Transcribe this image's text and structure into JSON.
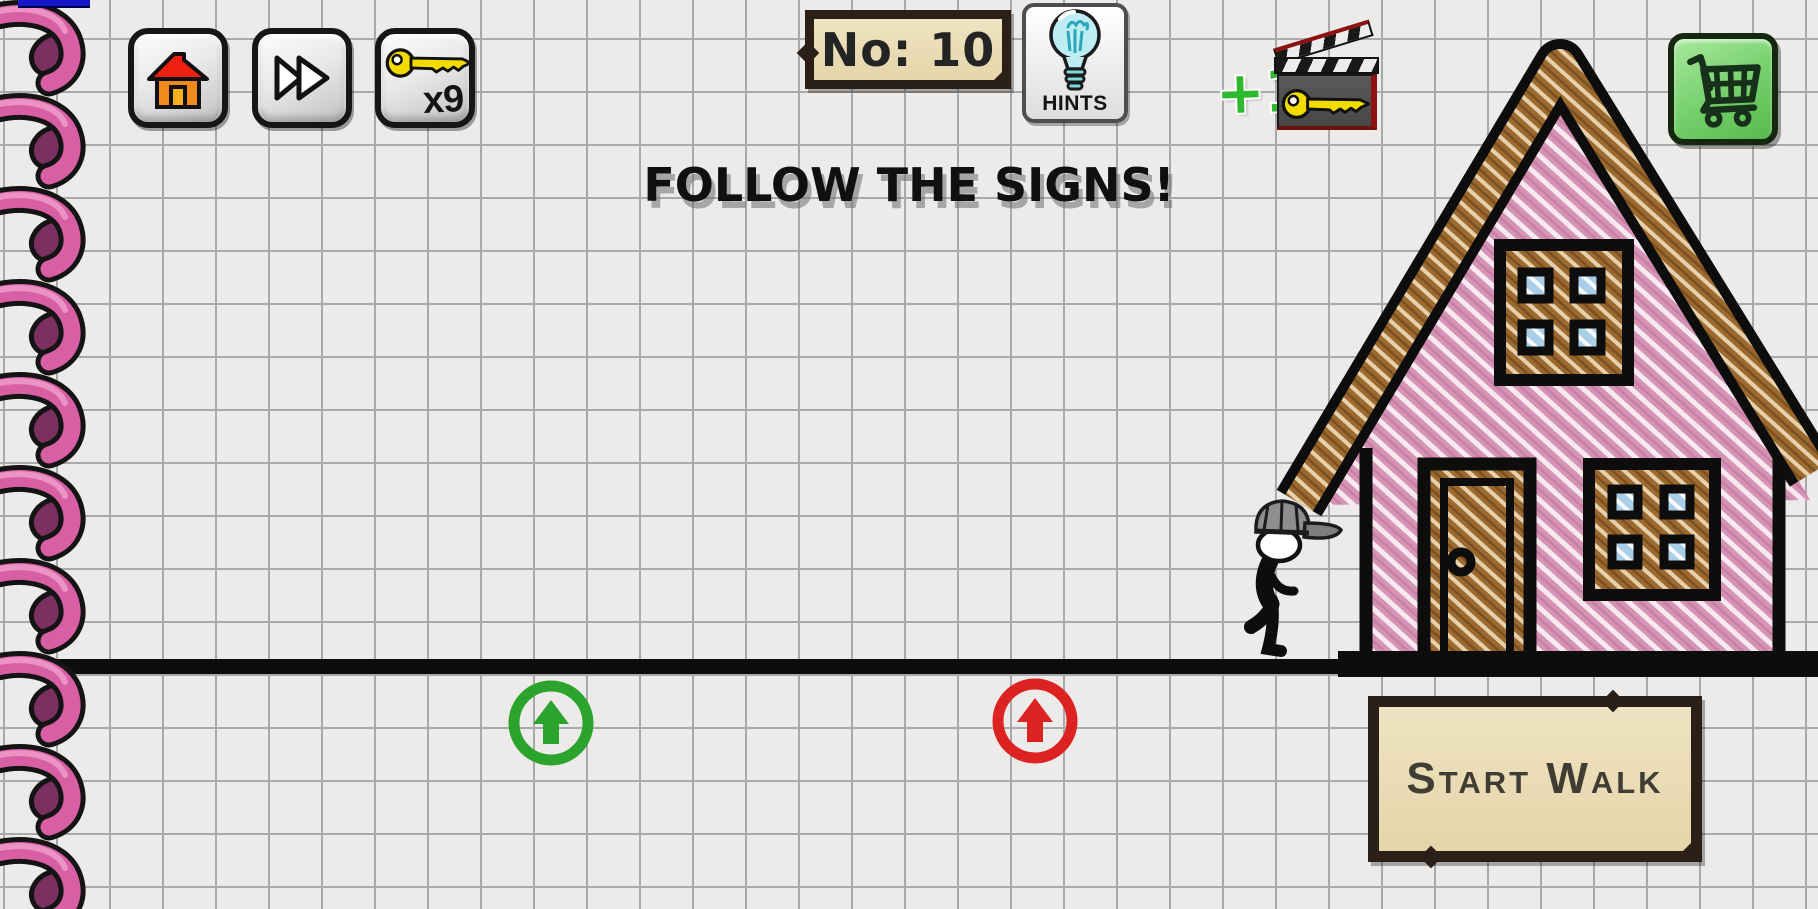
{
  "game": {
    "name": "stickman-walk-puzzle"
  },
  "colors": {
    "paper": "#ecebe9",
    "grid_line": "#a9a9a9",
    "ink": "#0d0d0d",
    "house_pink": "#d593b6",
    "wood_brown": "#9c6a2e",
    "pane_blue": "#a9cfe8",
    "parchment": "#ece0bc",
    "parchment_border": "#2a2018",
    "sign_green": "#2ca32c",
    "sign_red": "#dd2222",
    "cart_green": "#74cf6a",
    "spiral_pink": "#d85fa4",
    "spiral_hole": "#7b3060",
    "plus_one_green": "#2db82d",
    "key_yellow": "#f2dc00",
    "bulb_cyan": "#9fe5ee"
  },
  "topbar": {
    "home": {
      "icon": "home-icon"
    },
    "skip": {
      "icon": "fast-forward-icon"
    },
    "keys": {
      "icon": "key-icon",
      "count_label": "x9"
    },
    "level": {
      "label": "No: 10"
    },
    "hints": {
      "icon": "lightbulb-icon",
      "label": "HINTS"
    },
    "ad_reward": {
      "bonus_label": "+1",
      "icon": "clapperboard-key-icon"
    },
    "shop": {
      "icon": "shopping-cart-icon"
    }
  },
  "hud": {
    "instruction": "FOLLOW THE SIGNS!"
  },
  "scene": {
    "character": "stickman-with-cap",
    "building": "pink-doodle-house",
    "signs": [
      {
        "name": "green-up-arrow-sign",
        "color": "#2ca32c",
        "direction": "up"
      },
      {
        "name": "red-up-arrow-sign",
        "color": "#dd2222",
        "direction": "up"
      }
    ]
  },
  "actions": {
    "start_walk_label": "Start Walk"
  }
}
